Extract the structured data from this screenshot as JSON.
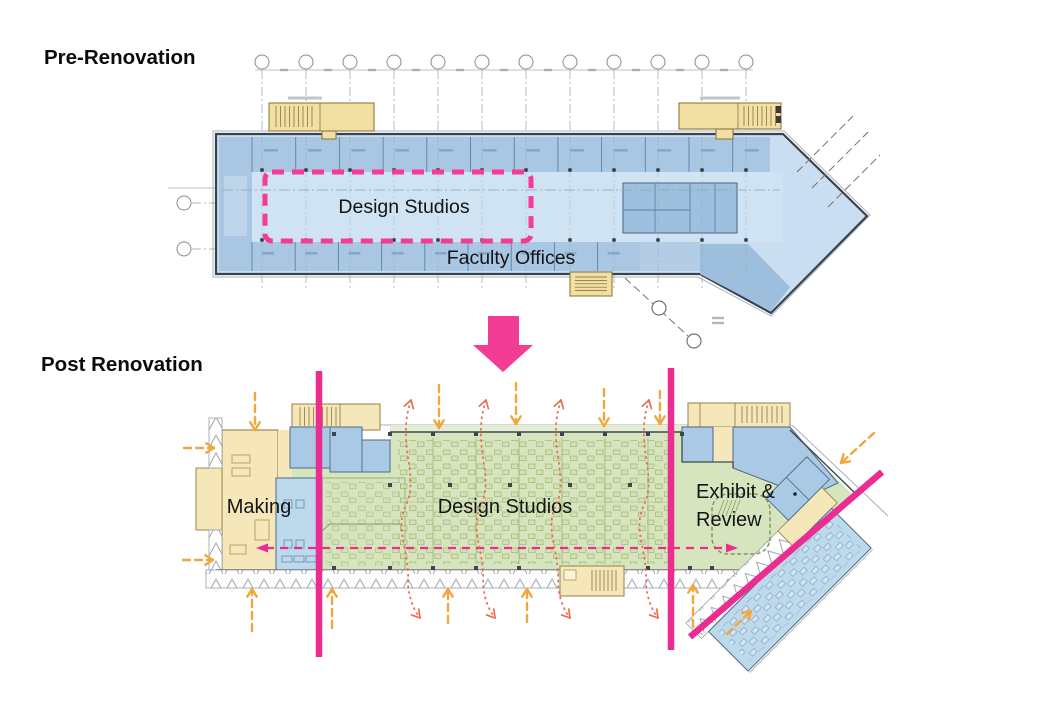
{
  "titles": {
    "pre": "Pre-Renovation",
    "post": "Post Renovation"
  },
  "pre_plan": {
    "labels": {
      "design_studios": "Design Studios",
      "faculty_offices": "Faculty Offices"
    }
  },
  "post_plan": {
    "labels": {
      "making": "Making",
      "design_studios": "Design Studios",
      "exhibit_line1": "Exhibit &",
      "exhibit_line2": "Review"
    }
  },
  "colors": {
    "magenta": "#EB2D92",
    "magenta_bright": "#F33C93",
    "highlight_pink": "#F43B97",
    "orange": "#F2A63C",
    "red": "#EC6A52",
    "pre_room_blue": "#A9C7E2",
    "pre_light_blue": "#CFE3F3",
    "post_green": "#D7E5BE",
    "post_yellow": "#F5E7BA",
    "post_blue_dark": "#A9C9E4",
    "post_blue_light": "#BDD9EC"
  },
  "annotations": {
    "transform_arrow": {
      "points": "488,316 519,316 519,345 533,345 503,372 473,345 488,345"
    },
    "highlight_box": {
      "x": 265,
      "y": 172,
      "w": 266,
      "h": 69
    },
    "magenta_lines": [
      [
        319,
        371,
        319,
        657
      ],
      [
        671,
        368,
        671,
        650
      ],
      [
        882,
        472,
        690,
        637
      ]
    ],
    "flow_arrow": {
      "x1": 257,
      "x2": 737,
      "y": 548
    },
    "orange_arrows": [
      [
        255,
        393,
        255,
        430
      ],
      [
        439,
        385,
        439,
        428
      ],
      [
        516,
        383,
        516,
        424
      ],
      [
        604,
        389,
        604,
        426
      ],
      [
        660,
        391,
        660,
        424
      ],
      [
        874,
        433,
        841,
        463
      ],
      [
        184,
        448,
        214,
        448
      ],
      [
        183,
        560,
        213,
        560
      ],
      [
        252,
        631,
        252,
        589
      ],
      [
        332,
        628,
        332,
        589
      ],
      [
        448,
        623,
        448,
        589
      ],
      [
        527,
        622,
        527,
        589
      ],
      [
        693,
        627,
        693,
        585
      ],
      [
        727,
        634,
        751,
        611
      ]
    ],
    "red_flow_arrows": {
      "xs": [
        408,
        483,
        558,
        646
      ],
      "top": 398,
      "bottom": 620
    }
  }
}
